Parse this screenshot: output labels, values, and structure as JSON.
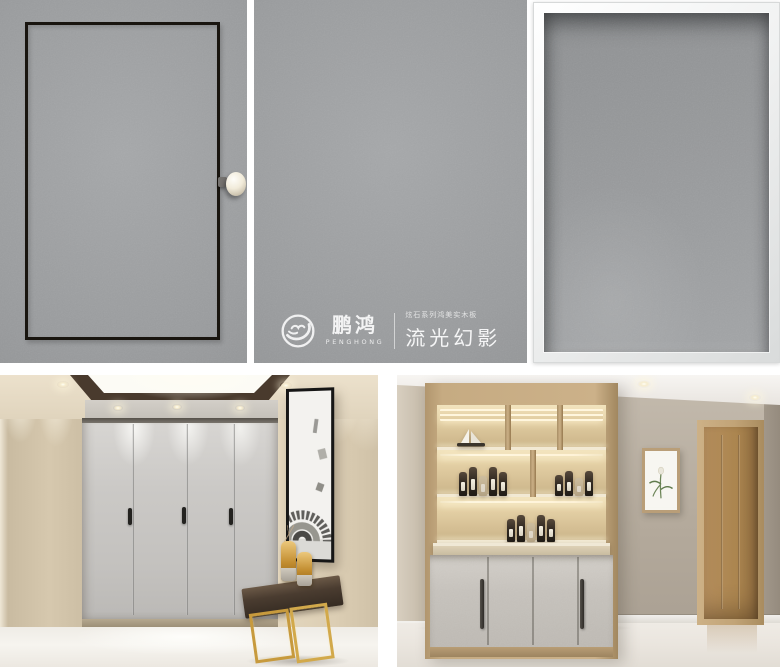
{
  "brand": {
    "name_cn": "鹏鸿",
    "name_en": "PENGHONG",
    "series_label": "炫石系列鸿美实木板",
    "product_name": "流光幻影"
  },
  "tiles": [
    {
      "id": "panel-black-inlay",
      "label": "gray panel door with black inlay frame and round knob"
    },
    {
      "id": "panel-logo",
      "label": "gray panel with PengHong brand logo"
    },
    {
      "id": "panel-silver-frame",
      "label": "gray panel sample in silver frame"
    },
    {
      "id": "photo-wardrobe-hallway",
      "label": "hallway with gray wardrobe doors, artwork and gold console"
    },
    {
      "id": "photo-display-cabinet",
      "label": "built-in lit display cabinet with gray doors and oak interior door"
    }
  ],
  "colors": {
    "background": "#ffffff",
    "panel_gray": "#9a9c9e",
    "inlay_black": "#19150f",
    "silver_frame": "#f1f2f2",
    "logo_text": "#f0f0f0",
    "wall_beige": "#ddd0b8",
    "wardrobe_gray": "#c9c7c4",
    "oak_wood": "#c6ab82",
    "gold_accent": "#c79a3d",
    "wall_greige": "#b4aa9c"
  }
}
